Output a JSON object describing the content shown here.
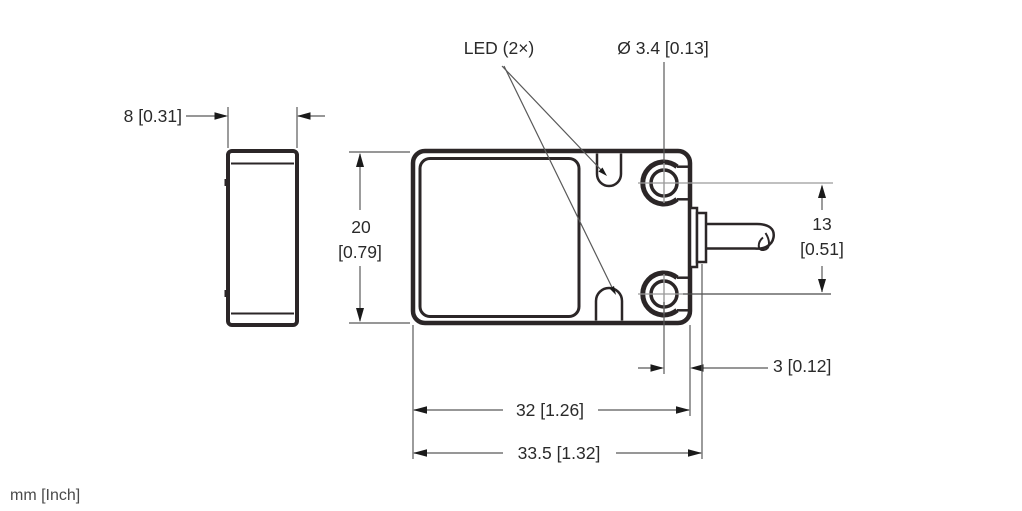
{
  "drawing": {
    "type": "technical-dimension-drawing",
    "views": [
      "side-view",
      "front-view-with-cable"
    ],
    "units_note": "mm [Inch]",
    "colors": {
      "outline": "#2b2627",
      "dimension_line": "#595959",
      "crosshair": "#9b9b9b",
      "text": "#2a2a2a",
      "background": "#ffffff"
    }
  },
  "labels": {
    "led": "LED (2×)",
    "hole_diameter": "Ø 3.4 [0.13]",
    "side_width": "8 [0.31]",
    "height_mm": "20",
    "height_inch": "[0.79]",
    "hole_spacing_mm": "13",
    "hole_spacing_inch": "[0.51]",
    "hole_edge_offset": "3 [0.12]",
    "body_length": "32 [1.26]",
    "overall_length": "33.5 [1.32]",
    "units": "mm [Inch]"
  },
  "dimensions": [
    {
      "feature": "housing depth (side view)",
      "mm": 8,
      "inch": 0.31
    },
    {
      "feature": "housing height",
      "mm": 20,
      "inch": 0.79
    },
    {
      "feature": "mounting hole spacing",
      "mm": 13,
      "inch": 0.51
    },
    {
      "feature": "hole center to housing end",
      "mm": 3,
      "inch": 0.12
    },
    {
      "feature": "housing length",
      "mm": 32,
      "inch": 1.26
    },
    {
      "feature": "overall length incl. cable gland",
      "mm": 33.5,
      "inch": 1.32
    },
    {
      "feature": "mounting hole diameter",
      "mm": 3.4,
      "inch": 0.13
    },
    {
      "feature": "LED count",
      "count": 2
    }
  ]
}
